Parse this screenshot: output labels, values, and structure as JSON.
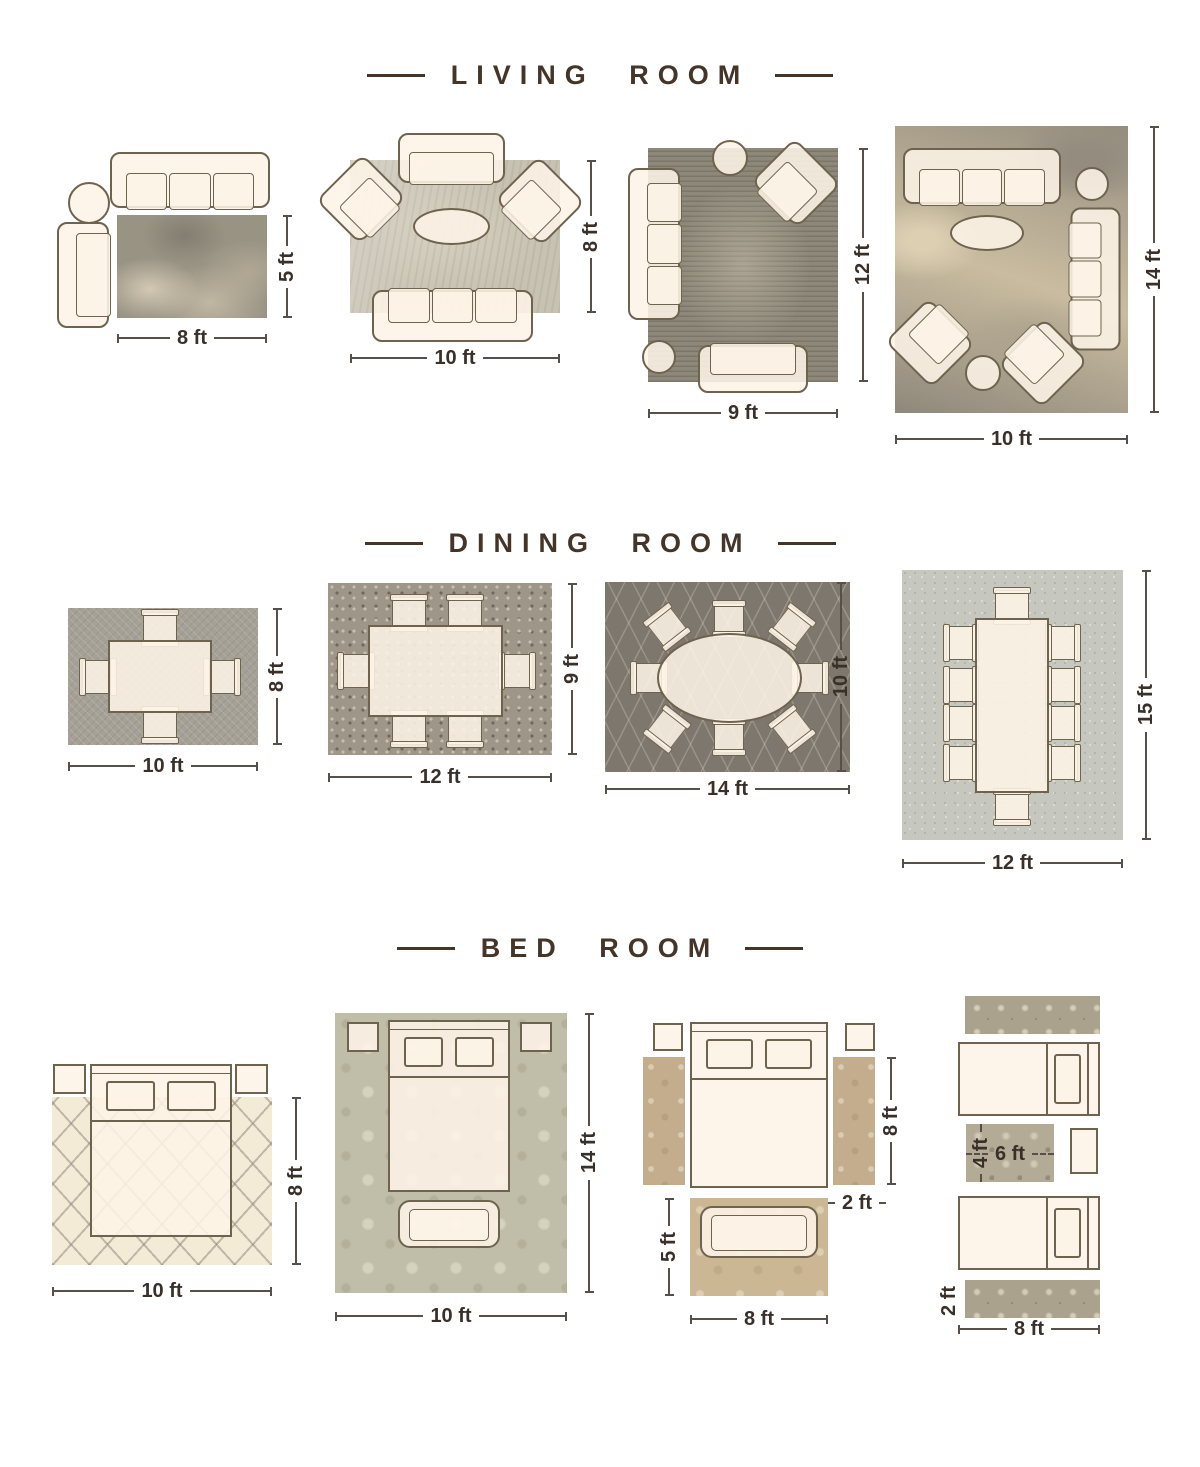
{
  "colors": {
    "title": "#443528",
    "dimension_text": "#39302a",
    "furniture_fill": "#fdf4e7",
    "furniture_outline": "#6e634f"
  },
  "sections": [
    {
      "title": "LIVING ROOM",
      "layouts": [
        {
          "rug": "8x5",
          "width_label": "8 ft",
          "height_label": "5 ft"
        },
        {
          "rug": "10x8",
          "width_label": "10 ft",
          "height_label": "8 ft"
        },
        {
          "rug": "9x12",
          "width_label": "9 ft",
          "height_label": "12 ft"
        },
        {
          "rug": "10x14",
          "width_label": "10 ft",
          "height_label": "14 ft"
        }
      ]
    },
    {
      "title": "DINING ROOM",
      "layouts": [
        {
          "rug": "10x8",
          "width_label": "10 ft",
          "height_label": "8 ft"
        },
        {
          "rug": "12x9",
          "width_label": "12 ft",
          "height_label": "9 ft"
        },
        {
          "rug": "14x10",
          "width_label": "14 ft",
          "height_label": "10 ft"
        },
        {
          "rug": "12x15",
          "width_label": "12 ft",
          "height_label": "15 ft"
        }
      ]
    },
    {
      "title": "BED ROOM",
      "layouts": [
        {
          "rug": "10x8",
          "width_label": "10 ft",
          "height_label": "8 ft"
        },
        {
          "rug": "10x14",
          "width_label": "10 ft",
          "height_label": "14 ft"
        },
        {
          "rug": "side-runners-and-foot-rug",
          "runner_length_label": "8 ft",
          "runner_width_label": "2 ft",
          "foot_rug_height_label": "5 ft",
          "foot_rug_width_label": "8 ft"
        },
        {
          "rug": "twin-beds-runners",
          "center_rug_height_label": "4 ft",
          "center_rug_width_label": "6 ft",
          "runner_width_label": "2 ft",
          "bed_width_label": "8 ft"
        }
      ]
    }
  ]
}
